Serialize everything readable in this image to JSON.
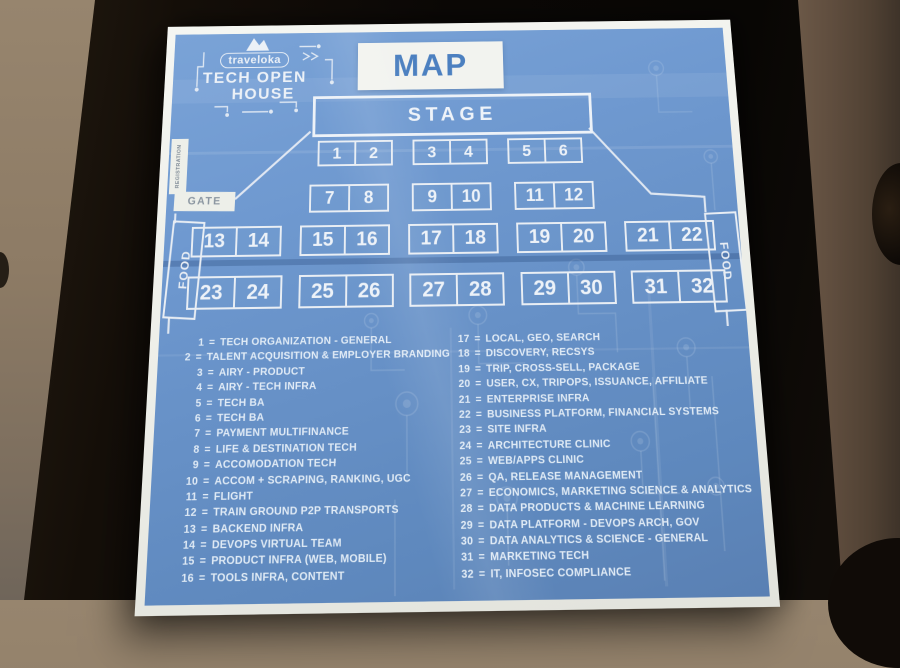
{
  "poster": {
    "logo": {
      "brand": "traveloka",
      "line1": "TECH OPEN",
      "line2": "HOUSE"
    },
    "title": "MAP",
    "stage_label": "STAGE",
    "gate_label": "GATE",
    "registration_label": "REGISTRATION",
    "food_left_label": "FOOD",
    "food_right_label": "FOOD",
    "booth_rows": [
      [
        "1",
        "2",
        "3",
        "4",
        "5",
        "6"
      ],
      [
        "7",
        "8",
        "9",
        "10",
        "11",
        "12"
      ],
      [
        "13",
        "14",
        "15",
        "16",
        "17",
        "18",
        "19",
        "20",
        "21",
        "22"
      ],
      [
        "23",
        "24",
        "25",
        "26",
        "27",
        "28",
        "29",
        "30",
        "31",
        "32"
      ]
    ],
    "legend_separator": "=",
    "legend_left": [
      {
        "num": "1",
        "label": "TECH ORGANIZATION - GENERAL"
      },
      {
        "num": "2",
        "label": "TALENT ACQUISITION & EMPLOYER BRANDING"
      },
      {
        "num": "3",
        "label": "AIRY - PRODUCT"
      },
      {
        "num": "4",
        "label": "AIRY - TECH INFRA"
      },
      {
        "num": "5",
        "label": "TECH BA"
      },
      {
        "num": "6",
        "label": "TECH BA"
      },
      {
        "num": "7",
        "label": "PAYMENT MULTIFINANCE"
      },
      {
        "num": "8",
        "label": "LIFE & DESTINATION TECH"
      },
      {
        "num": "9",
        "label": "ACCOMODATION TECH"
      },
      {
        "num": "10",
        "label": "ACCOM + SCRAPING, RANKING, UGC"
      },
      {
        "num": "11",
        "label": "FLIGHT"
      },
      {
        "num": "12",
        "label": "TRAIN GROUND P2P TRANSPORTS"
      },
      {
        "num": "13",
        "label": "BACKEND INFRA"
      },
      {
        "num": "14",
        "label": "DEVOPS VIRTUAL TEAM"
      },
      {
        "num": "15",
        "label": "PRODUCT INFRA (WEB, MOBILE)"
      },
      {
        "num": "16",
        "label": "TOOLS INFRA, CONTENT"
      }
    ],
    "legend_right": [
      {
        "num": "17",
        "label": "LOCAL, GEO, SEARCH"
      },
      {
        "num": "18",
        "label": "DISCOVERY, RECSYS"
      },
      {
        "num": "19",
        "label": "TRIP, CROSS-SELL, PACKAGE"
      },
      {
        "num": "20",
        "label": "USER, CX, TRIPOPS, ISSUANCE, AFFILIATE"
      },
      {
        "num": "21",
        "label": "ENTERPRISE INFRA"
      },
      {
        "num": "22",
        "label": "BUSINESS PLATFORM, FINANCIAL SYSTEMS"
      },
      {
        "num": "23",
        "label": "SITE INFRA"
      },
      {
        "num": "24",
        "label": "ARCHITECTURE CLINIC"
      },
      {
        "num": "25",
        "label": "WEB/APPS CLINIC"
      },
      {
        "num": "26",
        "label": "QA, RELEASE MANAGEMENT"
      },
      {
        "num": "27",
        "label": "ECONOMICS, MARKETING SCIENCE & ANALYTICS"
      },
      {
        "num": "28",
        "label": "DATA PRODUCTS & MACHINE LEARNING"
      },
      {
        "num": "29",
        "label": "DATA PLATFORM - DEVOPS ARCH, GOV"
      },
      {
        "num": "30",
        "label": "DATA ANALYTICS & SCIENCE - GENERAL"
      },
      {
        "num": "31",
        "label": "MARKETING TECH"
      },
      {
        "num": "32",
        "label": "IT, INFOSEC COMPLIANCE"
      }
    ],
    "colors": {
      "poster_blue": "#6690c6",
      "paper_white": "#f2f3ef",
      "line_white": "#e9eef4",
      "title_blue": "#4c80c0"
    }
  }
}
